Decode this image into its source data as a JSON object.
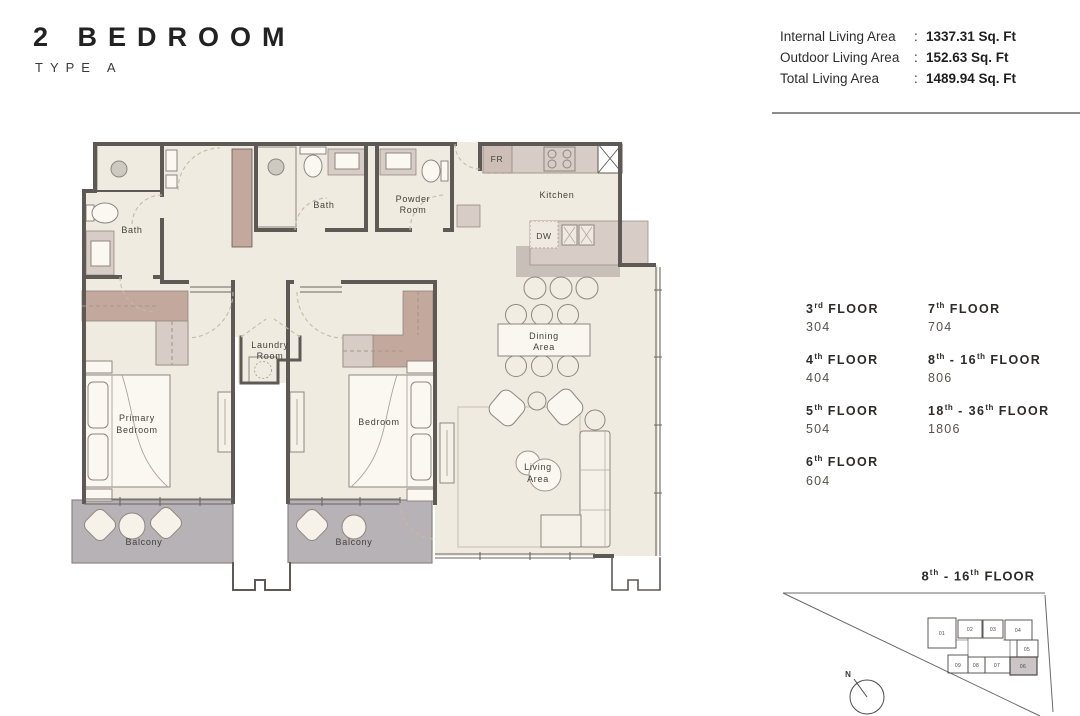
{
  "header": {
    "title": "2 BEDROOM",
    "subtitle": "TYPE A"
  },
  "stats": {
    "rows": [
      {
        "label": "Internal Living Area",
        "sep": ":",
        "value": "1337.31 Sq. Ft"
      },
      {
        "label": "Outdoor Living Area",
        "sep": ":",
        "value": "152.63 Sq. Ft"
      },
      {
        "label": "Total Living Area",
        "sep": ":",
        "value": "1489.94 Sq. Ft"
      }
    ]
  },
  "plan": {
    "labels": {
      "bath_ensuite": "Bath",
      "bath_main": "Bath",
      "powder": [
        "Powder",
        "Room"
      ],
      "kitchen": "Kitchen",
      "fridge_abbr": "FR",
      "dishwasher_abbr": "DW",
      "dining": [
        "Dining",
        "Area"
      ],
      "laundry": [
        "Laundry",
        "Room"
      ],
      "primary_bedroom": [
        "Primary",
        "Bedroom"
      ],
      "bedroom": "Bedroom",
      "living": [
        "Living",
        "Area"
      ],
      "balcony_left": "Balcony",
      "balcony_right": "Balcony"
    }
  },
  "floors": {
    "items": [
      {
        "n1": "3",
        "s1": "rd",
        "mid": "",
        "n2": "",
        "s2": "",
        "word": " FLOOR",
        "unit": "304"
      },
      {
        "n1": "7",
        "s1": "th",
        "mid": "",
        "n2": "",
        "s2": "",
        "word": " FLOOR",
        "unit": "704"
      },
      {
        "n1": "4",
        "s1": "th",
        "mid": "",
        "n2": "",
        "s2": "",
        "word": " FLOOR",
        "unit": "404"
      },
      {
        "n1": "8",
        "s1": "th",
        "mid": " - ",
        "n2": "16",
        "s2": "th",
        "word": " FLOOR",
        "unit": "806"
      },
      {
        "n1": "5",
        "s1": "th",
        "mid": "",
        "n2": "",
        "s2": "",
        "word": " FLOOR",
        "unit": "504"
      },
      {
        "n1": "18",
        "s1": "th",
        "mid": " - ",
        "n2": "36",
        "s2": "th",
        "word": " FLOOR",
        "unit": "1806"
      },
      {
        "n1": "6",
        "s1": "th",
        "mid": "",
        "n2": "",
        "s2": "",
        "word": " FLOOR",
        "unit": "604"
      }
    ]
  },
  "key_plan": {
    "floor_label": {
      "n1": "8",
      "s1": "th",
      "mid": " - ",
      "n2": "16",
      "s2": "th",
      "word": " FLOOR"
    },
    "units": [
      "01",
      "02",
      "03",
      "04",
      "05",
      "06",
      "07",
      "08",
      "09"
    ],
    "highlighted_unit": "06",
    "compass": "N"
  },
  "colors": {
    "wall": "#5e5955",
    "floor_cream": "#f0ebe1",
    "accent_mauve": "#c2a89d",
    "accent_mauve_light": "#d7ccc6",
    "island_shadow": "#c9bfb9",
    "balcony_gray": "#b7b2b6",
    "highlight_unit": "#cbc5c8"
  }
}
